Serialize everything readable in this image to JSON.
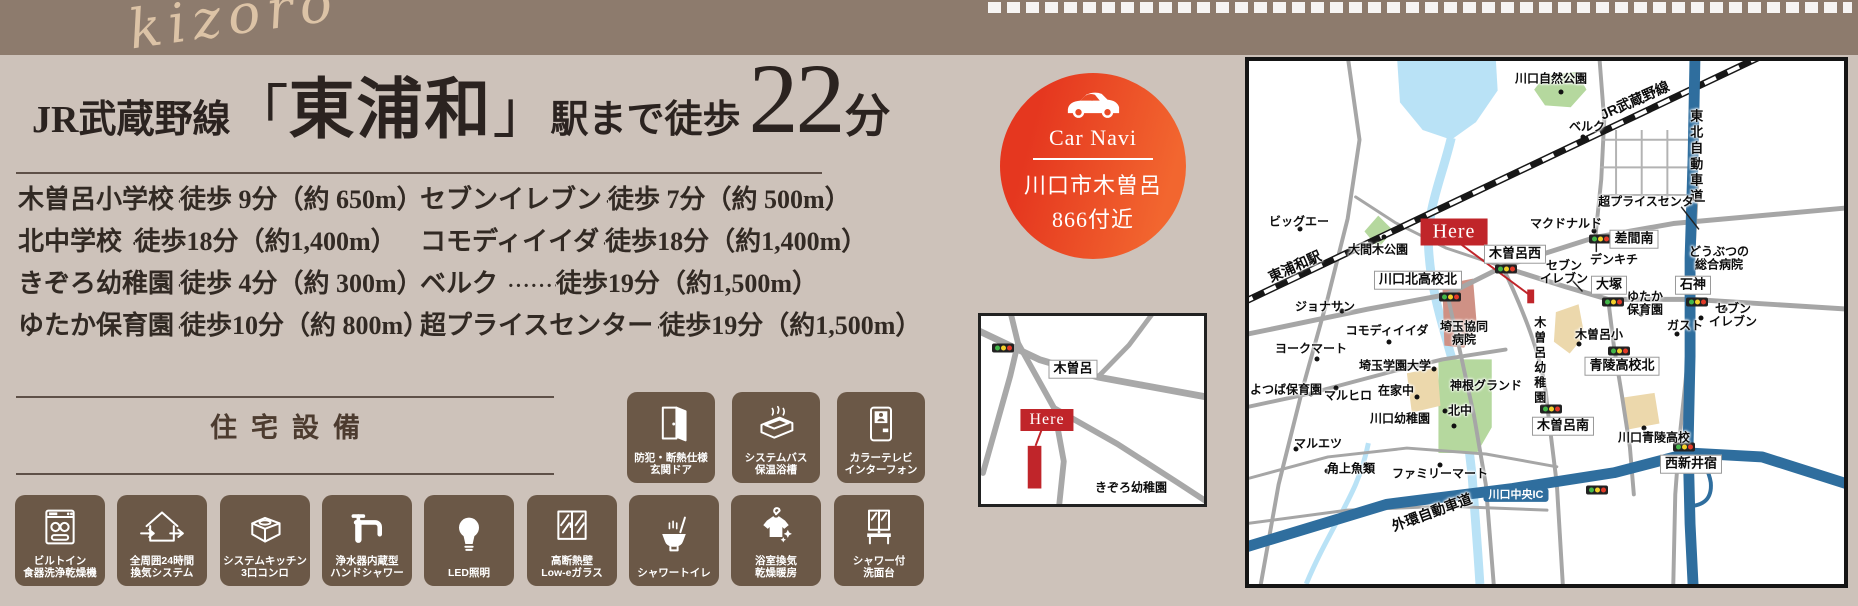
{
  "banner": {
    "watermark": "kizoro"
  },
  "colors": {
    "band": "#8d7b6d",
    "tile_brown": "#6b5847",
    "navi_red": "#e5371f",
    "here_red": "#c0252a",
    "highway_blue": "#2f6e9e"
  },
  "headline": {
    "prefix": "JR武蔵野線",
    "bracket_open": "「",
    "station": "東浦和",
    "bracket_close": "」",
    "suffix": "駅まで徒歩",
    "minutes": "22",
    "unit": "分"
  },
  "access_list": {
    "left": [
      {
        "name": "木曽呂小学校",
        "dots": "··················",
        "value": "徒歩 9分（約 650m）"
      },
      {
        "name": "北中学校 ",
        "dots": "··························",
        "value": "徒歩18分（約1,400m）"
      },
      {
        "name": "きぞろ幼稚園",
        "dots": "······················",
        "value": "徒歩 4分（約 300m）"
      },
      {
        "name": "ゆたか保育園",
        "dots": "······················",
        "value": "徒歩10分（約 800m）"
      }
    ],
    "right": [
      {
        "name": "セブンイレブン",
        "dots": "······················",
        "value": "徒歩 7分（約 500m）"
      },
      {
        "name": "コモディイイダ",
        "dots": "····················",
        "value": "徒歩18分（約1,400m）"
      },
      {
        "name": "ベルク ",
        "dots": "······························",
        "value": "徒歩19分（約1,500m）"
      },
      {
        "name": "超プライスセンター",
        "dots": "··········",
        "value": "徒歩19分（約1,500m）"
      }
    ]
  },
  "equipment": {
    "section_title": "住宅設備",
    "top_row": [
      {
        "icon": "entrance-door-icon",
        "label": "防犯・断熱仕様\n玄関ドア"
      },
      {
        "icon": "bathtub-icon",
        "label": "システムバス\n保温浴槽"
      },
      {
        "icon": "intercom-icon",
        "label": "カラーテレビ\nインターフォン"
      }
    ],
    "bottom_row": [
      {
        "icon": "dishwasher-icon",
        "label": "ビルトイン\n食器洗浄乾燥機"
      },
      {
        "icon": "ventilation-icon",
        "label": "全周囲24時間\n換気システム"
      },
      {
        "icon": "stove-icon",
        "label": "システムキッチン\n3口コンロ"
      },
      {
        "icon": "faucet-icon",
        "label": "浄水器内蔵型\nハンドシャワー"
      },
      {
        "icon": "led-bulb-icon",
        "label": "LED照明"
      },
      {
        "icon": "window-icon",
        "label": "高断熱壁\nLow-eガラス"
      },
      {
        "icon": "shower-toilet-icon",
        "label": "シャワートイレ"
      },
      {
        "icon": "bath-dryer-icon",
        "label": "浴室換気\n乾燥暖房"
      },
      {
        "icon": "vanity-icon",
        "label": "シャワー付\n洗面台"
      }
    ]
  },
  "car_navi": {
    "title": "Car Navi",
    "address_line1": "川口市木曽呂",
    "address_line2": "866付近",
    "icon": "car-icon"
  },
  "small_map": {
    "labels": [
      {
        "text": "木曽呂",
        "x": 92,
        "y": 53,
        "type": "box"
      },
      {
        "text": "Here",
        "x": 66,
        "y": 104,
        "type": "here"
      },
      {
        "text": "きぞろ幼稚園",
        "x": 150,
        "y": 172
      }
    ],
    "traffic_lights": [
      {
        "x": 22,
        "y": 32
      }
    ]
  },
  "large_map": {
    "labels": [
      {
        "text": "川口自然公園",
        "x": 302,
        "y": 18
      },
      {
        "text": "JR武蔵野線",
        "x": 386,
        "y": 40,
        "rot": -24,
        "size": 14
      },
      {
        "text": "東北自動車道",
        "x": 446,
        "y": 96,
        "vert": true,
        "size": 13
      },
      {
        "text": "ベルク",
        "x": 338,
        "y": 66
      },
      {
        "text": "超プライスセンター",
        "x": 403,
        "y": 141
      },
      {
        "text": "ビッグエー",
        "x": 50,
        "y": 161
      },
      {
        "text": "大間木公園",
        "x": 129,
        "y": 189
      },
      {
        "text": "東浦和駅",
        "x": 46,
        "y": 206,
        "rot": -24,
        "size": 14
      },
      {
        "text": "Here",
        "x": 205,
        "y": 171,
        "type": "here"
      },
      {
        "text": "木曽呂西",
        "x": 266,
        "y": 193,
        "type": "box"
      },
      {
        "text": "マクドナルド",
        "x": 317,
        "y": 163
      },
      {
        "text": "差間南",
        "x": 385,
        "y": 178,
        "type": "box"
      },
      {
        "text": "デンキチ",
        "x": 365,
        "y": 199
      },
      {
        "text": "どうぶつの\n総合病院",
        "x": 470,
        "y": 198
      },
      {
        "text": "セブン\nイレブン",
        "x": 315,
        "y": 212
      },
      {
        "text": "大塚",
        "x": 360,
        "y": 224,
        "type": "box"
      },
      {
        "text": "ゆたか\n保育園",
        "x": 396,
        "y": 243
      },
      {
        "text": "石神",
        "x": 444,
        "y": 224,
        "type": "box"
      },
      {
        "text": "ガスト",
        "x": 436,
        "y": 265
      },
      {
        "text": "セブン\nイレブン",
        "x": 484,
        "y": 255
      },
      {
        "text": "川口北高校北",
        "x": 169,
        "y": 219,
        "type": "box"
      },
      {
        "text": "ジョナサン",
        "x": 76,
        "y": 246
      },
      {
        "text": "コモディイイダ",
        "x": 138,
        "y": 270
      },
      {
        "text": "埼玉協同\n病院",
        "x": 215,
        "y": 273
      },
      {
        "text": "ヨークマート",
        "x": 62,
        "y": 288
      },
      {
        "text": "埼玉学園大学",
        "x": 146,
        "y": 305
      },
      {
        "text": "よつば保育園",
        "x": 37,
        "y": 329
      },
      {
        "text": "マルヒロ",
        "x": 99,
        "y": 335
      },
      {
        "text": "在家中",
        "x": 147,
        "y": 330
      },
      {
        "text": "川口幼稚園",
        "x": 151,
        "y": 358
      },
      {
        "text": "北中",
        "x": 211,
        "y": 350
      },
      {
        "text": "神根グランド",
        "x": 237,
        "y": 325
      },
      {
        "text": "木曽呂幼稚園",
        "x": 290,
        "y": 300,
        "vert": true
      },
      {
        "text": "木曽呂小",
        "x": 350,
        "y": 274
      },
      {
        "text": "青陵高校北",
        "x": 373,
        "y": 305,
        "type": "box"
      },
      {
        "text": "木曽呂南",
        "x": 314,
        "y": 365,
        "type": "box"
      },
      {
        "text": "川口青陵高校",
        "x": 405,
        "y": 377
      },
      {
        "text": "西新井宿",
        "x": 442,
        "y": 403,
        "type": "box"
      },
      {
        "text": "マルエツ",
        "x": 69,
        "y": 383
      },
      {
        "text": "角上魚類",
        "x": 102,
        "y": 408
      },
      {
        "text": "ファミリーマート",
        "x": 191,
        "y": 413
      },
      {
        "text": "川口中央IC",
        "x": 267,
        "y": 434,
        "type": "ic"
      },
      {
        "text": "外環自動車道",
        "x": 183,
        "y": 452,
        "rot": -20,
        "size": 14
      }
    ],
    "traffic_lights": [
      {
        "x": 257,
        "y": 208
      },
      {
        "x": 201,
        "y": 236
      },
      {
        "x": 351,
        "y": 178
      },
      {
        "x": 364,
        "y": 241
      },
      {
        "x": 448,
        "y": 241
      },
      {
        "x": 370,
        "y": 290
      },
      {
        "x": 302,
        "y": 348
      },
      {
        "x": 435,
        "y": 386
      },
      {
        "x": 348,
        "y": 429
      }
    ],
    "poi_dots": [
      [
        51,
        168
      ],
      [
        135,
        176
      ],
      [
        312,
        31
      ],
      [
        334,
        76
      ],
      [
        345,
        170
      ],
      [
        93,
        250
      ],
      [
        140,
        281
      ],
      [
        68,
        298
      ],
      [
        185,
        308
      ],
      [
        62,
        333
      ],
      [
        87,
        327
      ],
      [
        168,
        336
      ],
      [
        196,
        350
      ],
      [
        47,
        388
      ],
      [
        78,
        410
      ],
      [
        191,
        404
      ],
      [
        330,
        283
      ],
      [
        395,
        367
      ],
      [
        476,
        248
      ],
      [
        452,
        257
      ],
      [
        392,
        253
      ],
      [
        428,
        273
      ],
      [
        205,
        365
      ]
    ]
  }
}
